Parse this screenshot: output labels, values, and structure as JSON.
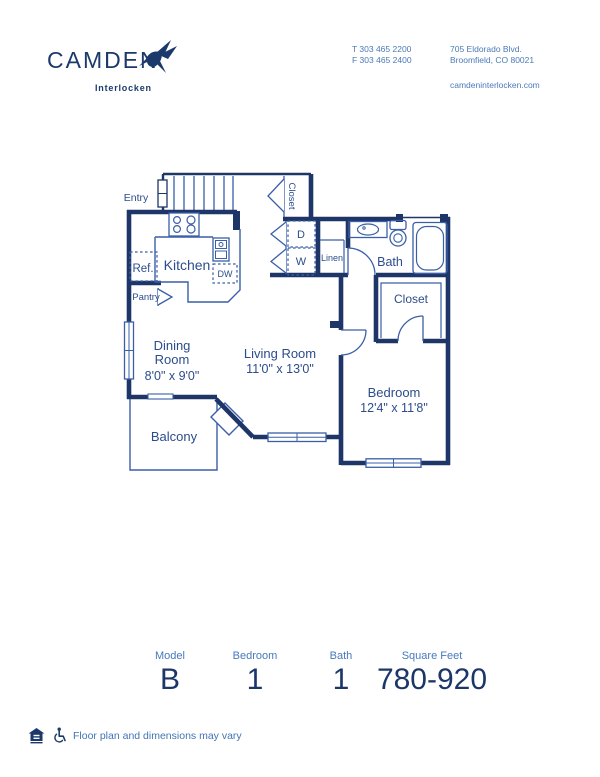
{
  "header": {
    "logo_name": "CAMDEN",
    "logo_sub": "Interlocken",
    "contact": {
      "phone1": "T 303 465 2200",
      "phone2": "F 303 465 2400",
      "address1": "705 Eldorado Blvd.",
      "address2": "Broomfield, CO 80021",
      "website": "camdeninterlocken.com"
    }
  },
  "floorplan": {
    "rooms": {
      "entry": "Entry",
      "kitchen": "Kitchen",
      "ref": "Ref.",
      "pantry": "Pantry",
      "dw": "DW",
      "dryer": "D",
      "washer": "W",
      "closet_top": "Closet",
      "linen": "Linen",
      "bath": "Bath",
      "closet_bedroom": "Closet",
      "dining_line1": "Dining",
      "dining_line2": "Room",
      "dining_dims": "8'0\" x 9'0\"",
      "living": "Living Room",
      "living_dims": "11'0\" x 13'0\"",
      "bedroom": "Bedroom",
      "bedroom_dims": "12'4\" x 11'8\"",
      "balcony": "Balcony"
    }
  },
  "stats": [
    {
      "label": "Model",
      "value": "B"
    },
    {
      "label": "Bedroom",
      "value": "1"
    },
    {
      "label": "Bath",
      "value": "1"
    },
    {
      "label": "Square Feet",
      "value": "780-920"
    }
  ],
  "footer": {
    "disclaimer": "Floor plan and dimensions may vary"
  },
  "colors": {
    "navy": "#1c3668",
    "label_blue": "#2c4d8c",
    "light_blue": "#4a7ab8"
  }
}
